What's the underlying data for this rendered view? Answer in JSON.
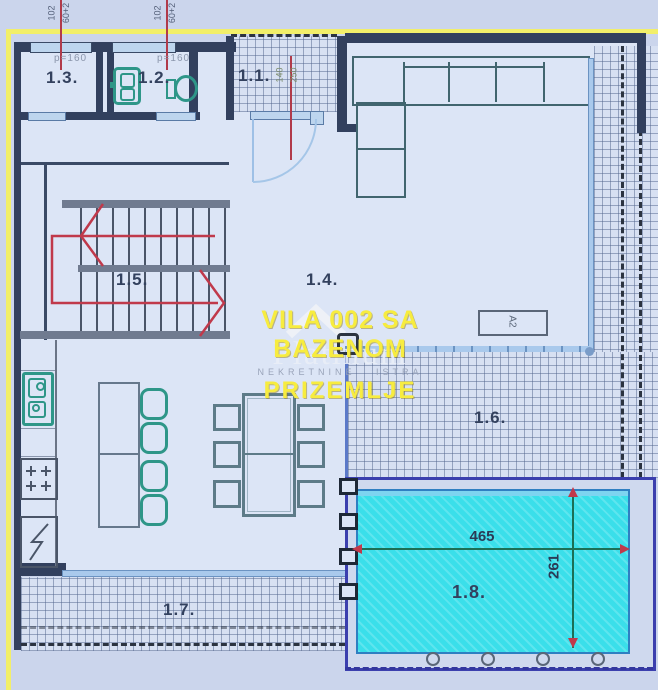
{
  "plan": {
    "watermark": {
      "line1": "VILA 002 SA BAZENOM",
      "brand": "Platinum",
      "tagline": "NEKRETNINE ISTRA",
      "line2": "PRIZEMLJE"
    },
    "rooms": {
      "r11": "1.1.",
      "r12": "1.2.",
      "r13": "1.3.",
      "r14": "1.4.",
      "r15": "1.5.",
      "r16": "1.6.",
      "r17": "1.7.",
      "r18": "1.8."
    },
    "annotations": {
      "parapet_a": "p=160",
      "parapet_b": "p=160",
      "win_w_a": "102",
      "win_h_a": "60+2",
      "win_w_b": "102",
      "win_h_b": "60+2",
      "door_w": "140",
      "door_h": "250",
      "unit_label": "A2",
      "pool_length": "465",
      "pool_width": "261"
    },
    "colors": {
      "pool_water": "#3adfea",
      "wall": "#32405e",
      "hatch_bg": "#d7e0f2",
      "watermark_yellow": "#f7ec3f",
      "boundary_yellow": "#f2ef6a",
      "stair_arrow_red": "#c0394b",
      "fixture_teal": "#2e9688",
      "dimension_green": "#1c6f55"
    }
  }
}
